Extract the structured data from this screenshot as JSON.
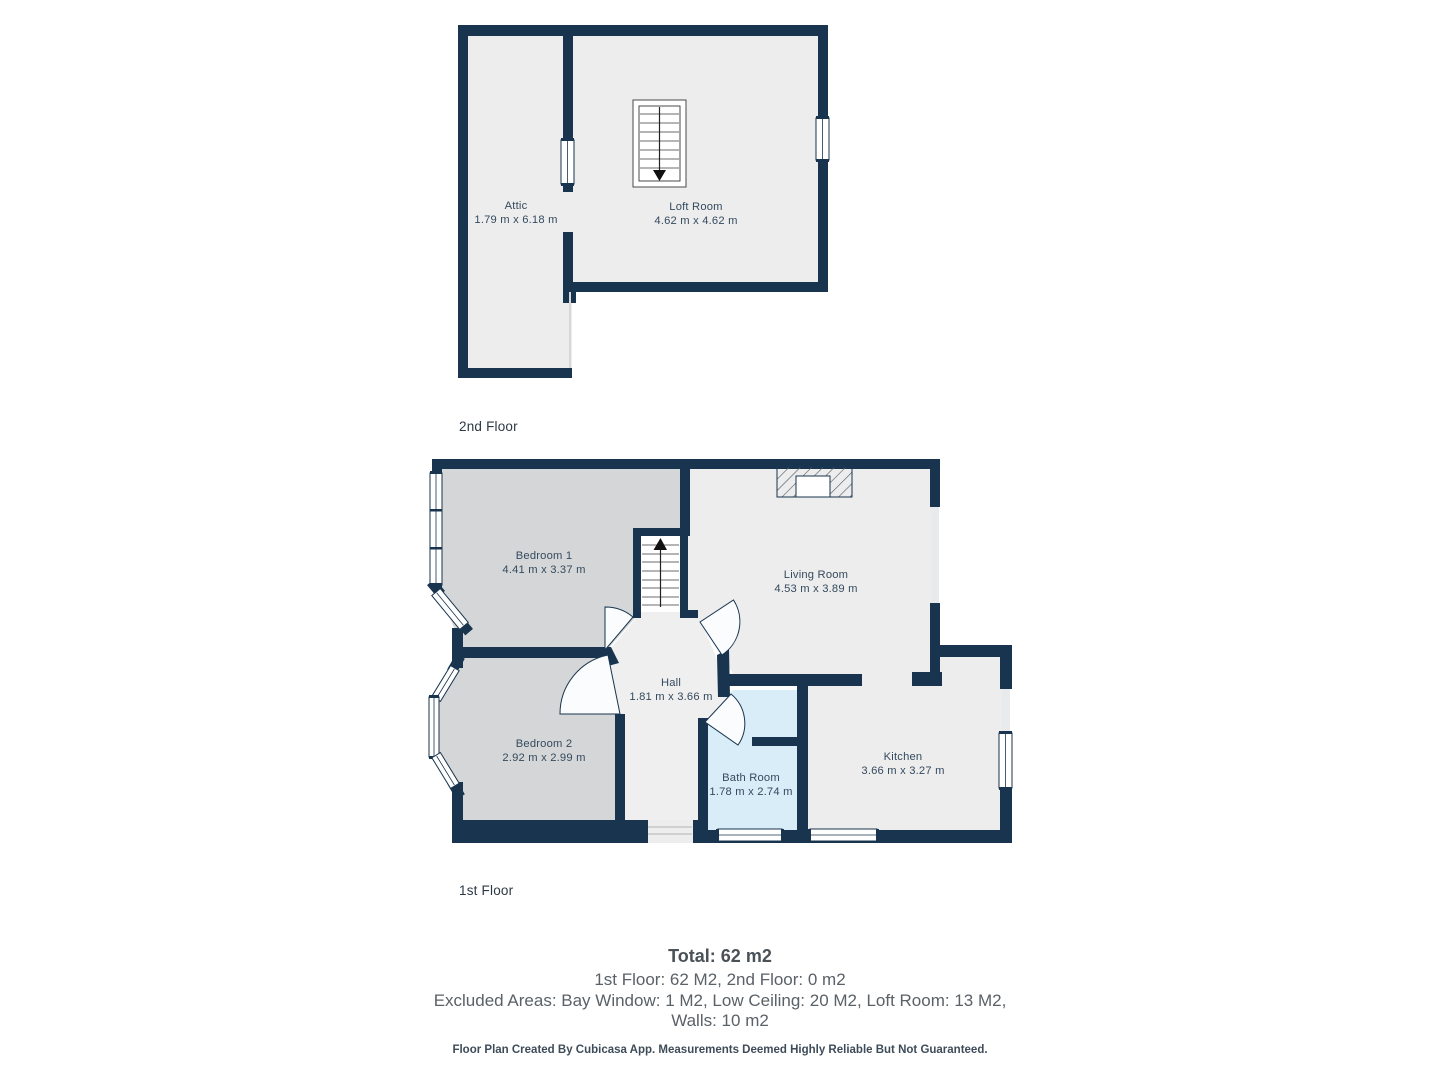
{
  "colors": {
    "wall": "#18344e",
    "floor_light": "#ededee",
    "floor_gray": "#d5d6d7",
    "floor_blue": "#d9edf8",
    "label_text": "#344a5e"
  },
  "floors": {
    "second": {
      "label": "2nd Floor",
      "rooms": {
        "attic": {
          "name": "Attic",
          "dims": "1.79 m x 6.18 m"
        },
        "loft": {
          "name": "Loft Room",
          "dims": "4.62 m x 4.62 m"
        }
      }
    },
    "first": {
      "label": "1st Floor",
      "rooms": {
        "bedroom1": {
          "name": "Bedroom 1",
          "dims": "4.41 m x 3.37 m"
        },
        "living": {
          "name": "Living Room",
          "dims": "4.53 m x 3.89 m"
        },
        "hall": {
          "name": "Hall",
          "dims": "1.81 m x 3.66 m"
        },
        "bedroom2": {
          "name": "Bedroom 2",
          "dims": "2.92 m x 2.99 m"
        },
        "bath": {
          "name": "Bath Room",
          "dims": "1.78 m x 2.74 m"
        },
        "kitchen": {
          "name": "Kitchen",
          "dims": "3.66 m x 3.27 m"
        }
      }
    }
  },
  "summary": {
    "total": "Total: 62 m2",
    "line1": "1st Floor: 62 M2, 2nd Floor: 0 m2",
    "line2": "Excluded Areas: Bay Window: 1 M2, Low Ceiling: 20 M2, Loft Room: 13 M2,",
    "line3": "Walls: 10 m2"
  },
  "footer": "Floor Plan Created By Cubicasa App. Measurements Deemed Highly Reliable But Not Guaranteed."
}
